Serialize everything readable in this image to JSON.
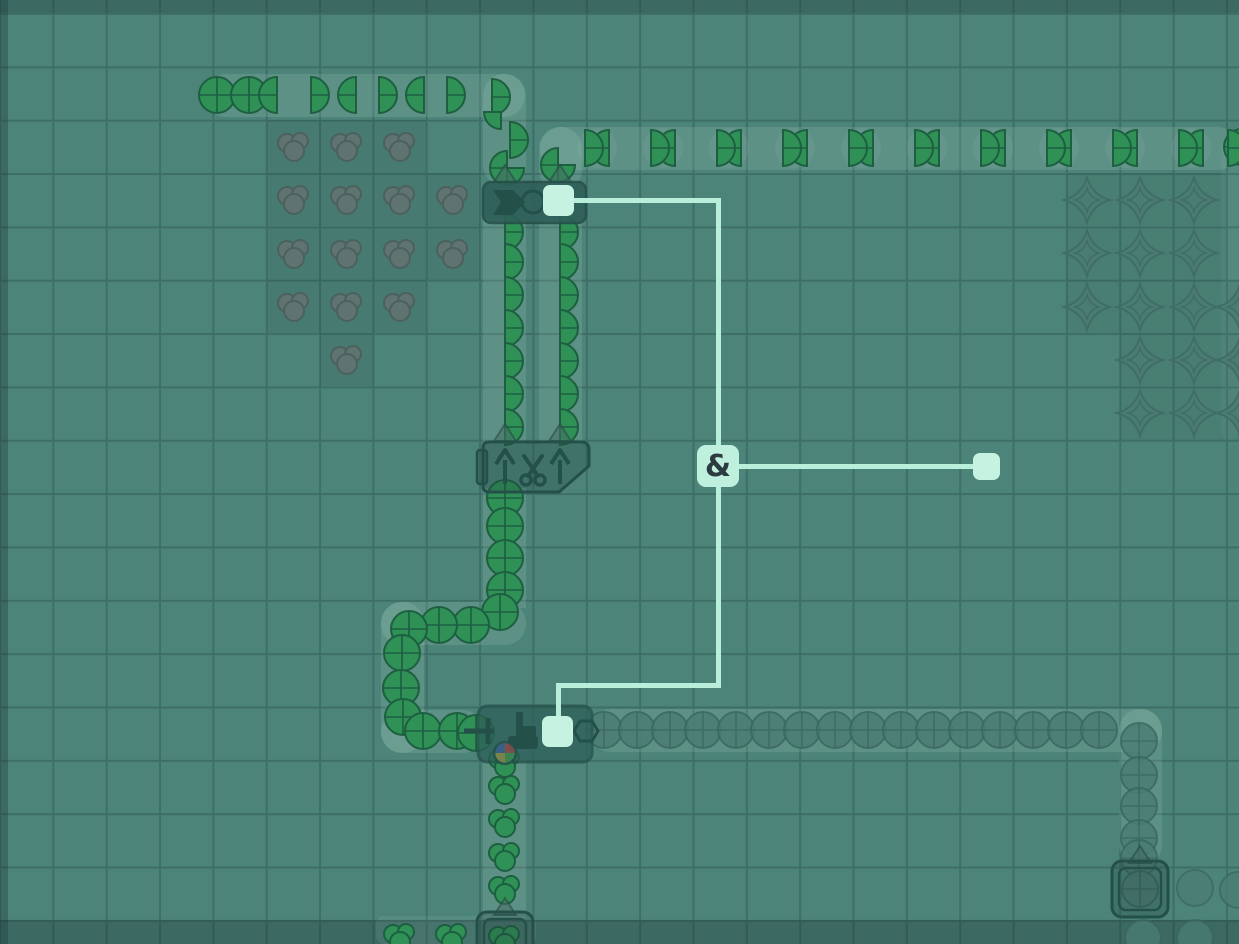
{
  "scene": {
    "width": 1239,
    "height": 944,
    "tile_size": 53.35,
    "layer": "wires-overlay"
  },
  "colors": {
    "background": "#4d8479",
    "grid_line": "#3e6f66",
    "belt_strip": "rgba(205,238,226,0.13)",
    "edge_strip": "rgba(22,48,50,0.30)",
    "item_green_fill": "#2f9156",
    "item_green_stroke": "#1d5f40",
    "item_dim_fill": "#4b7d74",
    "item_dim_stroke": "#3a675e",
    "patch_gray_fill": "#5f7470",
    "patch_gray_stroke": "#4c615d",
    "star_fill": "#4a7c72",
    "star_stroke": "#406e66",
    "building_fill": "#2e5f58",
    "building_stroke": "#265049",
    "building_detail": "#24504a",
    "wire": "#b9eeda",
    "wire_node_fill": "#c6f3e1",
    "gate_fill": "#bff0dd",
    "gate_text": "#2b3b3f",
    "wheel_blue": "#3a5f8f",
    "wheel_red": "#8f4a4a",
    "wheel_green": "#3f8a50",
    "wheel_yellow": "#8f8a4a"
  },
  "and_gate": {
    "label": "&",
    "x": 697,
    "y": 445,
    "size": 42,
    "font_size": 30
  },
  "wire_segments": [
    {
      "x": 558,
      "y": 198,
      "w": 163,
      "h": 5
    },
    {
      "x": 716,
      "y": 198,
      "w": 5,
      "h": 250
    },
    {
      "x": 720,
      "y": 464,
      "w": 262,
      "h": 5
    },
    {
      "x": 716,
      "y": 486,
      "w": 5,
      "h": 202
    },
    {
      "x": 556,
      "y": 683,
      "w": 165,
      "h": 5
    },
    {
      "x": 556,
      "y": 688,
      "w": 5,
      "h": 30
    }
  ],
  "wire_nodes": [
    {
      "x": 543,
      "y": 185,
      "s": 31
    },
    {
      "x": 973,
      "y": 453,
      "s": 27
    },
    {
      "x": 542,
      "y": 716,
      "s": 31
    }
  ],
  "edge_strips": [
    {
      "x": 0,
      "y": 0,
      "w": 1239,
      "h": 13
    },
    {
      "x": 0,
      "y": 920,
      "w": 1239,
      "h": 24
    },
    {
      "x": 0,
      "y": 0,
      "w": 8,
      "h": 944
    }
  ],
  "belt_paths": [
    {
      "x": 205,
      "y": 74,
      "w": 320,
      "h": 43,
      "r": 21,
      "o": 1
    },
    {
      "x": 483,
      "y": 74,
      "w": 43,
      "h": 112,
      "r": 21,
      "o": 1
    },
    {
      "x": 483,
      "y": 218,
      "w": 43,
      "h": 226,
      "r": 0,
      "o": 1
    },
    {
      "x": 539,
      "y": 218,
      "w": 43,
      "h": 226,
      "r": 0,
      "o": 1
    },
    {
      "x": 539,
      "y": 127,
      "w": 43,
      "h": 64,
      "r": 21,
      "o": 1
    },
    {
      "x": 540,
      "y": 127,
      "w": 699,
      "h": 43,
      "r": 21,
      "o": 1
    },
    {
      "x": 483,
      "y": 488,
      "w": 43,
      "h": 120,
      "r": 0,
      "o": 1
    },
    {
      "x": 381,
      "y": 602,
      "w": 145,
      "h": 43,
      "r": 21,
      "o": 1
    },
    {
      "x": 381,
      "y": 602,
      "w": 43,
      "h": 151,
      "r": 21,
      "o": 1
    },
    {
      "x": 381,
      "y": 710,
      "w": 103,
      "h": 43,
      "r": 21,
      "o": 1
    },
    {
      "x": 590,
      "y": 709,
      "w": 572,
      "h": 43,
      "r": 21,
      "o": 1
    },
    {
      "x": 1119,
      "y": 709,
      "w": 43,
      "h": 157,
      "r": 21,
      "o": 1
    },
    {
      "x": 483,
      "y": 760,
      "w": 43,
      "h": 158,
      "r": 0,
      "o": 1
    },
    {
      "x": 376,
      "y": 916,
      "w": 160,
      "h": 28,
      "r": 8,
      "o": 0.6
    },
    {
      "x": 1221,
      "y": 140,
      "w": 18,
      "h": 300,
      "r": 9,
      "o": 0.4
    }
  ],
  "ghost_slots": [
    [
      597,
      148
    ],
    [
      663,
      148
    ],
    [
      729,
      148
    ],
    [
      795,
      148
    ],
    [
      861,
      148
    ],
    [
      927,
      148
    ],
    [
      993,
      148
    ],
    [
      1059,
      148
    ],
    [
      1125,
      148
    ],
    [
      1191,
      148
    ]
  ],
  "patch_tint_cells": [
    {
      "x": 267,
      "y": 120,
      "w": 53,
      "h": 53,
      "a": 0.07
    },
    {
      "x": 320,
      "y": 120,
      "w": 53,
      "h": 53,
      "a": 0.07
    },
    {
      "x": 373,
      "y": 120,
      "w": 53,
      "h": 53,
      "a": 0.07
    },
    {
      "x": 267,
      "y": 173,
      "w": 53,
      "h": 53,
      "a": 0.07
    },
    {
      "x": 320,
      "y": 173,
      "w": 53,
      "h": 53,
      "a": 0.07
    },
    {
      "x": 373,
      "y": 173,
      "w": 53,
      "h": 53,
      "a": 0.07
    },
    {
      "x": 427,
      "y": 173,
      "w": 53,
      "h": 53,
      "a": 0.07
    },
    {
      "x": 267,
      "y": 227,
      "w": 53,
      "h": 53,
      "a": 0.07
    },
    {
      "x": 320,
      "y": 227,
      "w": 53,
      "h": 53,
      "a": 0.07
    },
    {
      "x": 373,
      "y": 227,
      "w": 53,
      "h": 53,
      "a": 0.07
    },
    {
      "x": 427,
      "y": 227,
      "w": 53,
      "h": 53,
      "a": 0.07
    },
    {
      "x": 267,
      "y": 280,
      "w": 53,
      "h": 53,
      "a": 0.07
    },
    {
      "x": 320,
      "y": 280,
      "w": 53,
      "h": 53,
      "a": 0.07
    },
    {
      "x": 373,
      "y": 280,
      "w": 53,
      "h": 53,
      "a": 0.07
    },
    {
      "x": 320,
      "y": 333,
      "w": 53,
      "h": 53,
      "a": 0.07
    },
    {
      "x": 1067,
      "y": 173,
      "w": 53,
      "h": 53,
      "a": 0.05
    },
    {
      "x": 1120,
      "y": 173,
      "w": 53,
      "h": 53,
      "a": 0.05
    },
    {
      "x": 1173,
      "y": 173,
      "w": 53,
      "h": 53,
      "a": 0.05
    },
    {
      "x": 1067,
      "y": 227,
      "w": 53,
      "h": 53,
      "a": 0.05
    },
    {
      "x": 1120,
      "y": 227,
      "w": 53,
      "h": 53,
      "a": 0.05
    },
    {
      "x": 1173,
      "y": 227,
      "w": 53,
      "h": 53,
      "a": 0.05
    },
    {
      "x": 1067,
      "y": 280,
      "w": 53,
      "h": 53,
      "a": 0.05
    },
    {
      "x": 1120,
      "y": 280,
      "w": 53,
      "h": 53,
      "a": 0.05
    },
    {
      "x": 1173,
      "y": 280,
      "w": 53,
      "h": 53,
      "a": 0.05
    },
    {
      "x": 1227,
      "y": 280,
      "w": 12,
      "h": 53,
      "a": 0.05
    },
    {
      "x": 1120,
      "y": 333,
      "w": 53,
      "h": 53,
      "a": 0.05
    },
    {
      "x": 1173,
      "y": 333,
      "w": 53,
      "h": 53,
      "a": 0.05
    },
    {
      "x": 1227,
      "y": 333,
      "w": 12,
      "h": 53,
      "a": 0.05
    },
    {
      "x": 1120,
      "y": 387,
      "w": 53,
      "h": 53,
      "a": 0.05
    },
    {
      "x": 1173,
      "y": 387,
      "w": 53,
      "h": 53,
      "a": 0.05
    },
    {
      "x": 1227,
      "y": 387,
      "w": 12,
      "h": 53,
      "a": 0.05
    }
  ],
  "color_patches": [
    [
      294,
      147
    ],
    [
      347,
      147
    ],
    [
      400,
      147
    ],
    [
      294,
      200
    ],
    [
      347,
      200
    ],
    [
      400,
      200
    ],
    [
      453,
      200
    ],
    [
      294,
      254
    ],
    [
      347,
      254
    ],
    [
      400,
      254
    ],
    [
      453,
      254
    ],
    [
      294,
      307
    ],
    [
      347,
      307
    ],
    [
      400,
      307
    ],
    [
      347,
      360
    ]
  ],
  "star_patches": [
    [
      1087,
      200
    ],
    [
      1140,
      200
    ],
    [
      1194,
      200
    ],
    [
      1087,
      253
    ],
    [
      1140,
      253
    ],
    [
      1194,
      253
    ],
    [
      1087,
      307
    ],
    [
      1140,
      307
    ],
    [
      1194,
      307
    ],
    [
      1240,
      307
    ],
    [
      1140,
      360
    ],
    [
      1194,
      360
    ],
    [
      1240,
      360
    ],
    [
      1140,
      413
    ],
    [
      1194,
      413
    ],
    [
      1240,
      413
    ]
  ],
  "circle_patches": [
    [
      1195,
      888
    ],
    [
      1238,
      890
    ],
    [
      1143,
      938
    ],
    [
      1195,
      938
    ]
  ],
  "items_green": {
    "full": [
      [
        217,
        95
      ],
      [
        249,
        95
      ],
      [
        1242,
        147
      ],
      [
        505,
        498
      ],
      [
        505,
        526
      ],
      [
        505,
        558
      ],
      [
        505,
        590
      ],
      [
        500,
        612
      ],
      [
        471,
        625
      ],
      [
        439,
        625
      ],
      [
        409,
        629
      ],
      [
        402,
        653
      ],
      [
        401,
        688
      ],
      [
        403,
        717
      ],
      [
        423,
        731
      ],
      [
        457,
        731
      ],
      [
        476,
        733
      ]
    ],
    "halfL": [
      [
        277,
        95
      ],
      [
        356,
        95
      ],
      [
        424,
        95
      ],
      [
        609,
        148
      ],
      [
        675,
        148
      ],
      [
        741,
        148
      ],
      [
        807,
        148
      ],
      [
        873,
        148
      ],
      [
        939,
        148
      ],
      [
        1005,
        148
      ],
      [
        1071,
        148
      ],
      [
        1137,
        148
      ],
      [
        1203,
        148
      ]
    ],
    "halfR": [
      [
        311,
        95
      ],
      [
        379,
        95
      ],
      [
        447,
        95
      ],
      [
        492,
        97
      ],
      [
        510,
        140
      ],
      [
        585,
        148
      ],
      [
        651,
        148
      ],
      [
        717,
        148
      ],
      [
        783,
        148
      ],
      [
        849,
        148
      ],
      [
        915,
        148
      ],
      [
        981,
        148
      ],
      [
        1047,
        148
      ],
      [
        1113,
        148
      ],
      [
        1179,
        148
      ],
      [
        1228,
        148
      ],
      [
        505,
        232
      ],
      [
        505,
        262
      ],
      [
        505,
        295
      ],
      [
        505,
        328
      ],
      [
        505,
        361
      ],
      [
        505,
        394
      ],
      [
        505,
        427
      ],
      [
        560,
        232
      ],
      [
        560,
        262
      ],
      [
        560,
        295
      ],
      [
        560,
        328
      ],
      [
        560,
        361
      ],
      [
        560,
        394
      ],
      [
        560,
        427
      ]
    ],
    "quarter": [
      [
        501,
        112
      ]
    ],
    "tq": [
      [
        507,
        168
      ],
      [
        558,
        165
      ]
    ],
    "cluster": [
      [
        505,
        763
      ],
      [
        505,
        790
      ],
      [
        505,
        823
      ],
      [
        505,
        857
      ],
      [
        505,
        890
      ],
      [
        505,
        940
      ],
      [
        400,
        938
      ],
      [
        452,
        938
      ]
    ]
  },
  "items_dim": {
    "circle": [
      [
        604,
        730
      ],
      [
        637,
        730
      ],
      [
        670,
        730
      ],
      [
        703,
        730
      ],
      [
        736,
        730
      ],
      [
        769,
        730
      ],
      [
        802,
        730
      ],
      [
        835,
        730
      ],
      [
        868,
        730
      ],
      [
        901,
        730
      ],
      [
        934,
        730
      ],
      [
        967,
        730
      ],
      [
        1000,
        730
      ],
      [
        1033,
        730
      ],
      [
        1066,
        730
      ],
      [
        1099,
        730
      ],
      [
        1139,
        741
      ],
      [
        1139,
        775
      ],
      [
        1139,
        806
      ],
      [
        1139,
        838
      ],
      [
        1139,
        858
      ],
      [
        1140,
        889
      ]
    ]
  },
  "arrows_up": [
    [
      505,
      174
    ],
    [
      560,
      174
    ],
    [
      505,
      433
    ],
    [
      560,
      433
    ],
    [
      1140,
      855
    ],
    [
      505,
      907
    ]
  ],
  "buildings": {
    "processor": {
      "x": 483,
      "y": 182,
      "w": 103,
      "h": 41
    },
    "cutter": {
      "x": 483,
      "y": 442,
      "w": 106,
      "h": 50
    },
    "painter": {
      "x": 478,
      "y": 706,
      "w": 114,
      "h": 56
    },
    "container_right": {
      "x": 1112,
      "y": 861,
      "w": 56,
      "h": 56
    },
    "container_bottom": {
      "x": 477,
      "y": 912,
      "w": 56,
      "h": 44
    }
  }
}
